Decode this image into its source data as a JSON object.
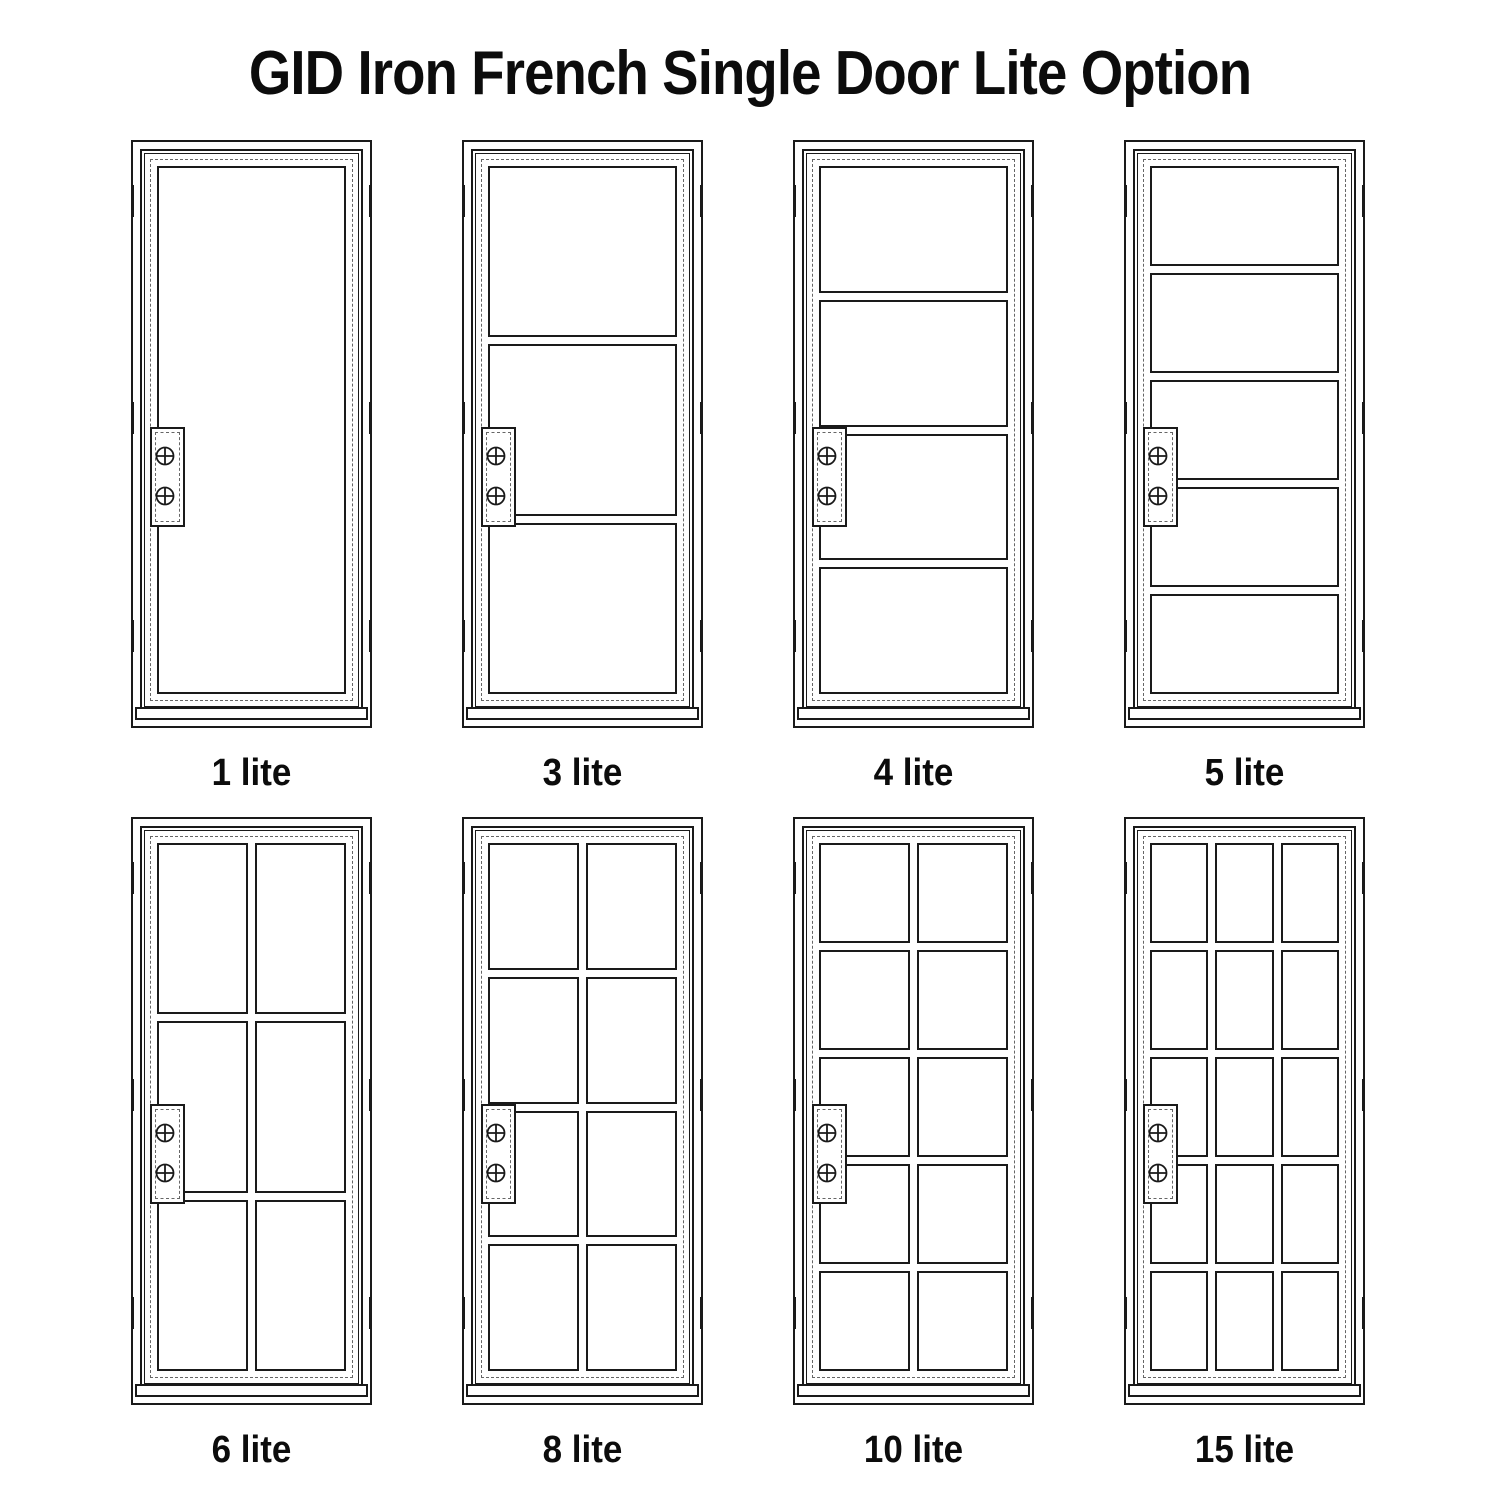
{
  "title": "GID Iron French Single Door Lite Option",
  "colors": {
    "line": "#1a1a1a",
    "dashed_line": "#666666",
    "background": "#ffffff",
    "text": "#0c0c0c"
  },
  "doors": [
    {
      "label": "1 lite",
      "lites": 1,
      "rows": 1,
      "cols": 1
    },
    {
      "label": "3 lite",
      "lites": 3,
      "rows": 3,
      "cols": 1
    },
    {
      "label": "4 lite",
      "lites": 4,
      "rows": 4,
      "cols": 1
    },
    {
      "label": "5 lite",
      "lites": 5,
      "rows": 5,
      "cols": 1
    },
    {
      "label": "6 lite",
      "lites": 6,
      "rows": 3,
      "cols": 2
    },
    {
      "label": "8 lite",
      "lites": 8,
      "rows": 4,
      "cols": 2
    },
    {
      "label": "10 lite",
      "lites": 10,
      "rows": 5,
      "cols": 2
    },
    {
      "label": "15 lite",
      "lites": 15,
      "rows": 5,
      "cols": 3
    }
  ],
  "icons": {
    "screw": "crossed-circle-screw-head",
    "hinge": "hinge-tick-mark"
  },
  "layout_note": "technical line drawing, two rows of four single doors"
}
